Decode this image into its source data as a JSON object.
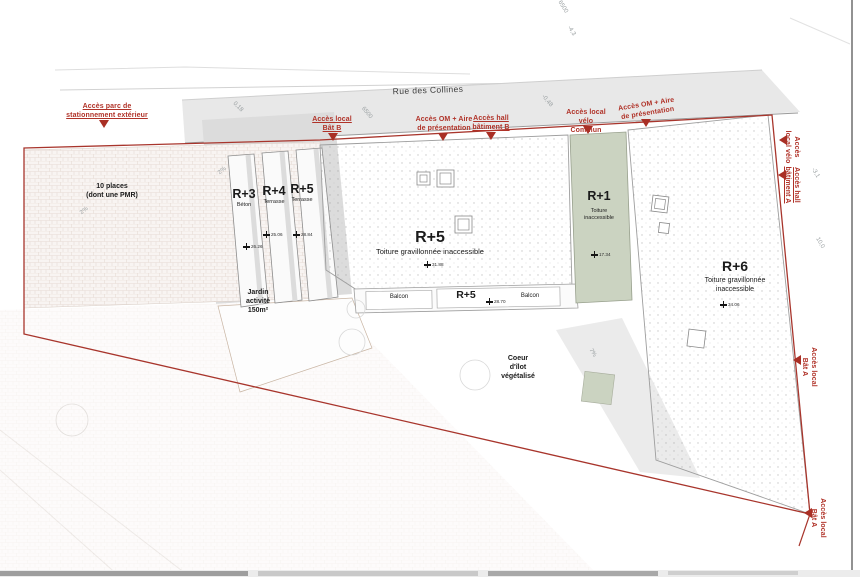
{
  "street": {
    "name": "Rue des Collines"
  },
  "access": {
    "parking": "Accès parc de\nstationnement extérieur",
    "local_bat_b": "Accès local\nBât B",
    "om_aire_1": "Accès OM + Aire\nde présentation",
    "hall_bat_b": "Accès hall\nbâtiment B",
    "velo_commun": "Accès local vélo\nCommun",
    "om_aire_2": "Accès OM + Aire\nde présentation",
    "velo_a": "Accès\nlocal vélo",
    "hall_bat_a": "Accès hall\nbâtiment A",
    "local_bat_a": "Accès local\nBât A",
    "local_bat_a_sud": "Accès local\nBât A"
  },
  "zones": {
    "parking_places": "10 places\n(dont une PMR)",
    "jardin": "Jardin\nactivité\n150m²",
    "coeur_ilot": "Coeur\nd'îlot\nvégétalisé"
  },
  "buildings": {
    "r3": {
      "name": "R+3",
      "roof": "Béton",
      "elev": "26.26"
    },
    "r4": {
      "name": "R+4",
      "roof": "Terrasse",
      "elev": "25.06"
    },
    "r5_bar": {
      "name": "R+5",
      "roof": "Terrasse",
      "elev": "28.84"
    },
    "r5_main": {
      "name": "R+5",
      "roof": "Toiture gravillonnée inaccessible",
      "elev": "31.88"
    },
    "r5_balcony": {
      "name": "R+5",
      "elev": "28.70",
      "balcon_left": "Balcon",
      "balcon_right": "Balcon"
    },
    "r1": {
      "name": "R+1",
      "roof": "Toiture\ninaccessible",
      "elev": "17.34"
    },
    "r6": {
      "name": "R+6",
      "roof": "Toiture gravillonnée\ninaccessible",
      "elev": "34.06"
    }
  },
  "dims": [
    "6500",
    "-4,3",
    "6500",
    "0,18",
    "-0,48",
    "-3,1",
    "10,0",
    "2%",
    "2%",
    "7%"
  ],
  "colors": {
    "boundary_red": "#a8352c",
    "annotation_red": "#b03228",
    "roof_green": "#cbd3c1",
    "street_gray": "#e8e8e8"
  }
}
